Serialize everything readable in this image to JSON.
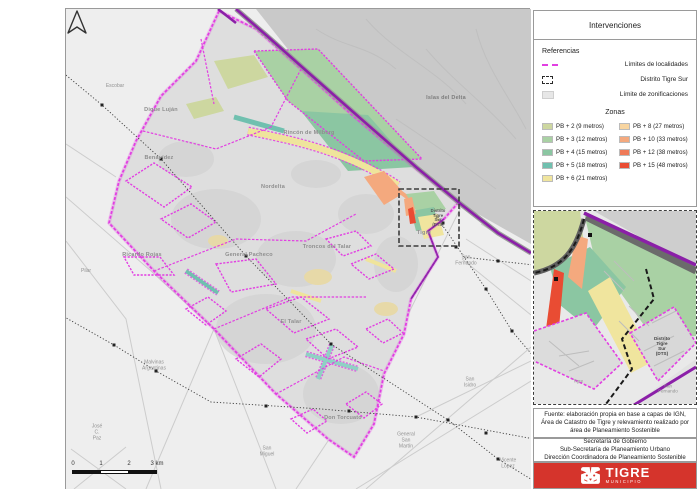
{
  "colors": {
    "locality_boundary_magenta": "#e23fe2",
    "district_outline_black": "#3c3c3c",
    "zonification_gray": "#e7e7e7",
    "river_purple": "#8b1fa8",
    "footer_red": "#d5342c"
  },
  "legend": {
    "title": "Intervenciones",
    "referencias": {
      "heading": "Referencias",
      "items": [
        {
          "label": "Límites de localidades"
        },
        {
          "label": "Distrito Tigre Sur"
        },
        {
          "label": "Límite de zonificaciones"
        }
      ]
    },
    "zonas": {
      "heading": "Zonas",
      "col1": [
        {
          "label": "PB + 2 (9 metros)",
          "color": "#cdd7a0"
        },
        {
          "label": "PB + 3 (12 metros)",
          "color": "#a9d1a4"
        },
        {
          "label": "PB + 4 (15 metros)",
          "color": "#8bc6a2"
        },
        {
          "label": "PB + 5 (18 metros)",
          "color": "#70c0af"
        },
        {
          "label": "PB + 6 (21 metros)",
          "color": "#f0e59e"
        }
      ],
      "col2": [
        {
          "label": "PB + 8 (27 metros)",
          "color": "#f8d5a0"
        },
        {
          "label": "PB + 10 (33 metros)",
          "color": "#f4a97e"
        },
        {
          "label": "PB + 12 (38 metros)",
          "color": "#ef7a58"
        },
        {
          "label": "PB + 15 (48 metros)",
          "color": "#e94c33"
        }
      ]
    }
  },
  "map": {
    "localities": [
      "Dique Luján",
      "Benavídez",
      "Rincón de Milberg",
      "Nordelta",
      "Ricardo Rojas",
      "General Pacheco",
      "Troncos del Talar",
      "El Talar",
      "Don Torcuato",
      "Tigre",
      "Islas del Delta"
    ],
    "neighbors": [
      "Escobar",
      "Pilar",
      "Malvinas\nArgentinas",
      "José\nC.\nPaz",
      "San\nMiguel",
      "General\nSan\nMartín",
      "Vicente\nLópez",
      "San\nIsidro",
      "San\nFernando"
    ],
    "district_box_label": "Distrito\nTigre\nSur\n(DTS)",
    "scalebar": [
      "0",
      "1",
      "2",
      "3 km"
    ]
  },
  "inset": {
    "district_label": "Distrito\nTigre\nSur\n(DTS)",
    "labels": [
      "San\nFernando",
      "Tigre"
    ]
  },
  "source_note": "Fuente: elaboración propia en base a capas de IGN, Área de Catastro de Tigre y relevamiento realizado por área de Planeamiento Sostenible",
  "credits": [
    "Secretaría de Gobierno",
    "Sub-Secretaría de Planeamiento Urbano",
    "Dirección Coordinadora de Planeamiento Sostenible"
  ],
  "footer": {
    "brand": "TIGRE",
    "brand_sub": "MUNICIPIO"
  }
}
